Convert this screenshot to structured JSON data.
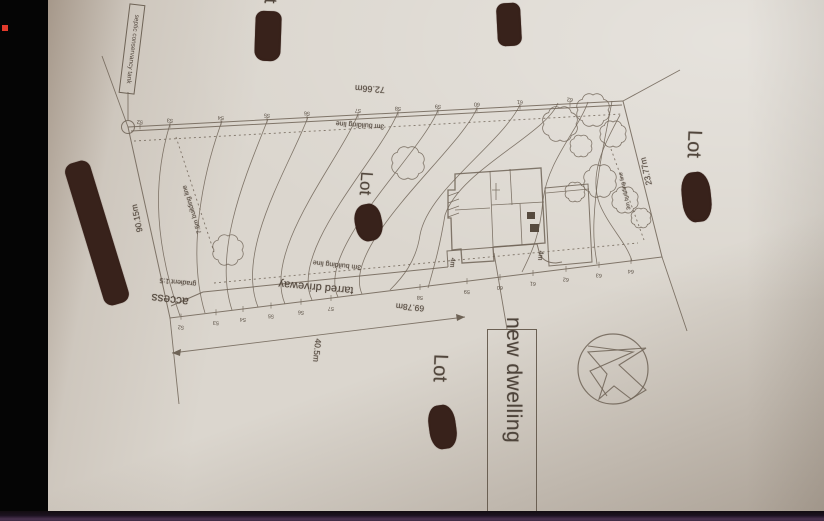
{
  "plan": {
    "new_dwelling_label": "new dwelling",
    "septic_label": "septic conservancy tank",
    "dimensions": {
      "top": "72.66m",
      "left": "90.15m",
      "bottom": "69.78m",
      "right": "23.77m",
      "driveway": "40.5m",
      "setback_a": "4m",
      "setback_b": "4m"
    },
    "building_lines": {
      "top": "3m building line",
      "bottom": "3m building line",
      "right": "3m building line",
      "left": "7.5m building line"
    },
    "driveway_label": "tarred driveway",
    "access_label": "access",
    "gradient_label": "gradient 1:5",
    "lot_labels": {
      "middle": "Lot",
      "right": "Lot",
      "bottom": "Lot",
      "top_partial": "Lot"
    },
    "contour_labels_top": [
      "52",
      "53",
      "54",
      "55",
      "56",
      "57",
      "58",
      "59",
      "60",
      "61",
      "62"
    ],
    "contour_labels_bottom": [
      "52",
      "53",
      "54",
      "55",
      "56",
      "57",
      "58",
      "59",
      "60",
      "61",
      "62",
      "63",
      "64"
    ],
    "colors": {
      "ink": "#6e6356",
      "redaction": "#38221b",
      "paper": "#dbd6ce",
      "bottom_bar_purple": "#49324f",
      "accent_red": "#e23a2b"
    }
  }
}
